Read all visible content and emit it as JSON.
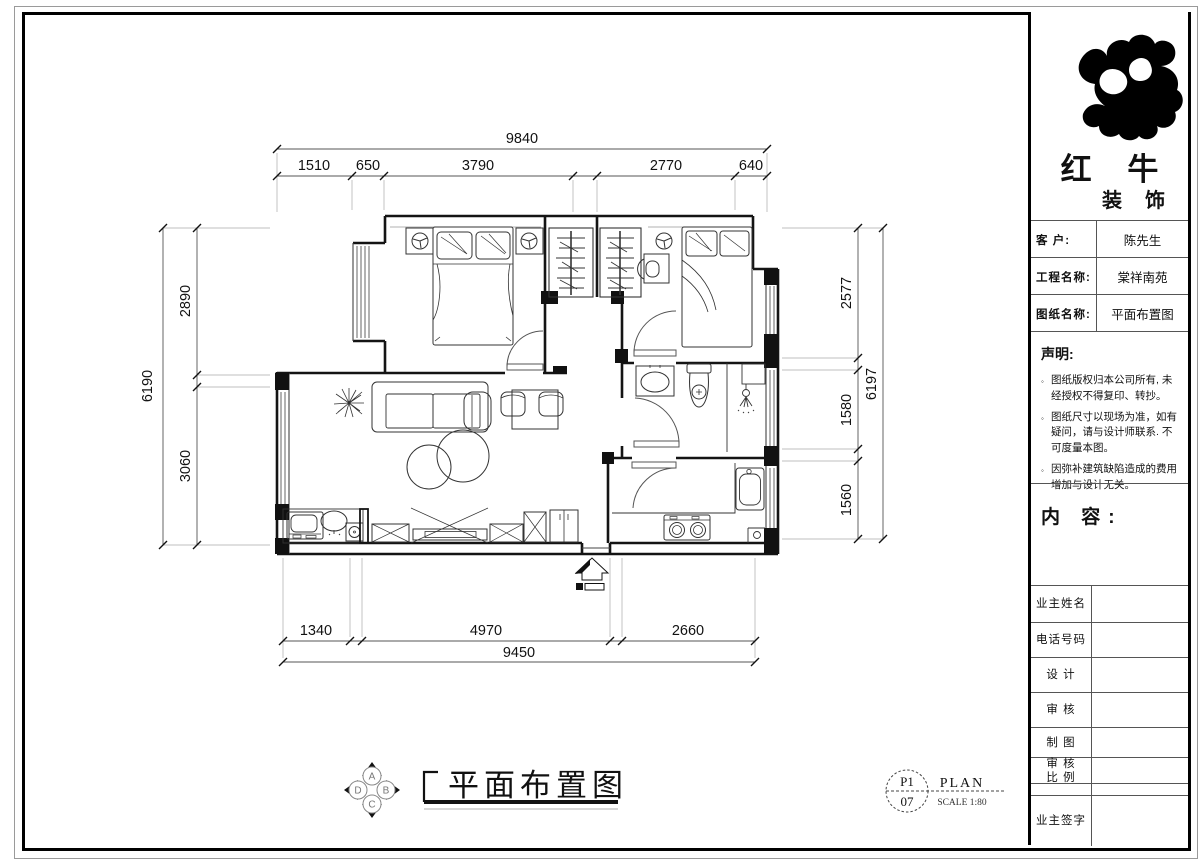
{
  "dims": {
    "top": {
      "total": "9840",
      "segments": [
        "1510",
        "650",
        "3790",
        "2770",
        "640"
      ]
    },
    "bottom": {
      "total": "9450",
      "segments": [
        "1340",
        "4970",
        "2660"
      ]
    },
    "left": {
      "total": "6190",
      "segments": [
        "2890",
        "3060"
      ]
    },
    "right": {
      "total": "6197",
      "segments": [
        "2577",
        "1580",
        "1560"
      ]
    }
  },
  "drawing": {
    "title": "平面布置图",
    "compass": {
      "a": "A",
      "b": "B",
      "c": "C",
      "d": "D"
    },
    "ref": {
      "top": "P1",
      "bottom": "07",
      "name": "PLAN",
      "scale": "SCALE 1:80"
    }
  },
  "title_block": {
    "brand": {
      "line1": "红 牛",
      "line2": "装 饰"
    },
    "info_rows": [
      {
        "label": "客  户:",
        "value": "陈先生"
      },
      {
        "label": "工程名称:",
        "value": "棠祥南苑"
      },
      {
        "label": "图纸名称:",
        "value": "平面布置图"
      }
    ],
    "statement": {
      "title": "声明:",
      "bullet": "◦",
      "items": [
        "图纸版权归本公司所有, 未经授权不得复印、转抄。",
        "图纸尺寸以现场为准，如有疑问，请与设计师联系. 不可度量本图。",
        "因弥补建筑缺陷造成的费用增加与设计无关。"
      ]
    },
    "content_label": "内 容:",
    "form_rows": {
      "owner_name": "业主姓名",
      "phone": "电话号码",
      "design": "设 计",
      "review": "审 核",
      "draft": "制 图",
      "review2": "审 核",
      "scale": "比 例",
      "owner_sign": "业主签字"
    }
  }
}
